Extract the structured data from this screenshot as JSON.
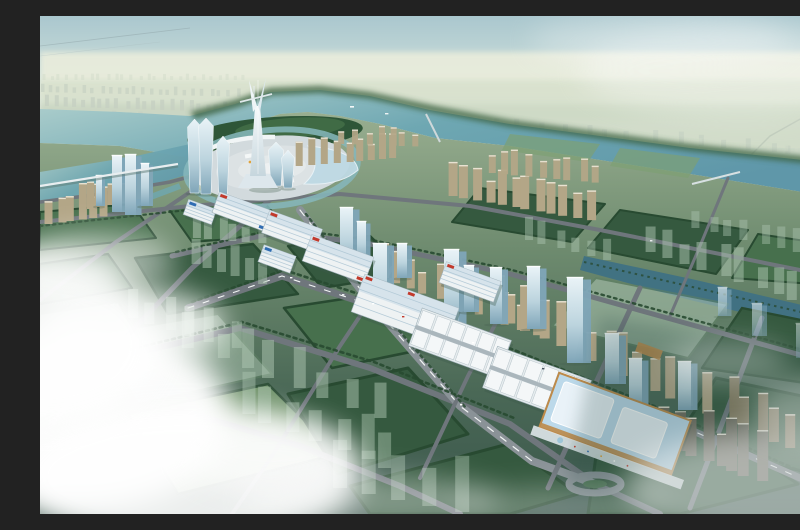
{
  "meta": {
    "description": "Aerial architectural rendering of a planned riverside city district with a landmark spire tower, circular central plaza, winding river, trade-center strip, exhibition hall and green development parcels under low clouds"
  },
  "palette": {
    "sky_top": "#aac7ce",
    "sky_mid": "#c9dcd9",
    "horizon": "#e7ece0",
    "sky_edge": "#eff1e6",
    "plain_hi": "#e8ecdc",
    "plain_md": "#d8e1cd",
    "plain_lo": "#cdd9c5",
    "plain_left": "#c9d5c3",
    "far_city": "#c5d0c2",
    "far_city_lt": "#d2dcca",
    "water_hi": "#b3d2cf",
    "water": "#6ea7b2",
    "water_lo": "#5f97a9",
    "water_dark": "#3f7184",
    "bank_green": "#3c6342",
    "forest": "#2e5638",
    "forest_lt": "#4c7a4f",
    "ground_hi": "#98ae90",
    "ground_md": "#6d8a6e",
    "ground_lo2": "#4a6856",
    "ground_lo": "#3a564b",
    "parcel_dark": "#35593f",
    "parcel_mid": "#47704d",
    "parcel_lt": "#7da073",
    "parcel_ghost": "#aec6b2",
    "hedge": "#284a31",
    "road": "#6f767c",
    "road_lt": "#8a9297",
    "dash": "#f2f5f4",
    "tan": "#b3a687",
    "tan_dk": "#8a7d62",
    "tan_cap": "#e8e2d2",
    "glass_hi": "#e9f3f7",
    "glass": "#bcd4de",
    "glass_dk": "#7fa5b8",
    "white_b": "#eef2f3",
    "roof_sh": "#aac3d2",
    "roof_blue": "#cfdfe9",
    "red": "#c23a2c",
    "blue": "#2f6cb3",
    "yellow": "#e0a33c",
    "expo_roof": "#bcd9ea",
    "expo_panel": "#e9f2f8",
    "expo_trim": "#bd8a4a",
    "spire_hi": "#f6fafb",
    "spire_lo": "#c6d6dd",
    "plaza": "#d2dadd",
    "plaza2": "#dce2e4",
    "plaza3": "#e4e9ea",
    "cloud": "#ffffff",
    "shadow": "#44604f"
  },
  "scene": {
    "clusters": [
      {
        "name": "far-city-row",
        "layer": "far",
        "x": 2,
        "y": 64,
        "n": 26,
        "dx": 8,
        "dy": 0,
        "w": 3,
        "h": 5,
        "fill": "far_city_lt",
        "op": 0.5
      },
      {
        "name": "far-city-row",
        "layer": "far",
        "x": 0,
        "y": 76,
        "n": 24,
        "dx": 8.5,
        "dy": 0.2,
        "w": 3.5,
        "h": 7,
        "fill": "far_city",
        "op": 0.65
      },
      {
        "name": "far-city-row",
        "layer": "far",
        "x": 4,
        "y": 90,
        "n": 22,
        "dx": 9,
        "dy": 0.3,
        "w": 4,
        "h": 9,
        "fill": "far_city",
        "op": 0.8
      },
      {
        "name": "far-city-row",
        "layer": "far",
        "x": 0,
        "y": 104,
        "n": 18,
        "dx": 10,
        "dy": 0.4,
        "w": 4.5,
        "h": 10,
        "fill": "far_city",
        "op": 0.85
      },
      {
        "name": "far-city-row",
        "layer": "far",
        "x": 30,
        "y": 118,
        "n": 12,
        "dx": 11,
        "dy": 0.5,
        "w": 5,
        "h": 11,
        "fill": "far_city",
        "op": 0.9
      },
      {
        "name": "north-bank-city",
        "layer": "far",
        "x": 336,
        "y": 102,
        "n": 20,
        "dx": 23,
        "dy": 2,
        "w": 5,
        "h": 10,
        "fill": "far_city",
        "op": 0.7
      },
      {
        "name": "north-bank-city",
        "layer": "far",
        "x": 390,
        "y": 124,
        "n": 18,
        "dx": 22,
        "dy": 2,
        "w": 6,
        "h": 13,
        "fill": "far_city",
        "op": 0.8
      },
      {
        "name": "north-bank-city",
        "layer": "far",
        "x": 470,
        "y": 148,
        "n": 16,
        "dx": 20,
        "dy": 2,
        "w": 7,
        "h": 14,
        "fill": "far_city",
        "op": 0.85
      },
      {
        "name": "north-bank-city",
        "layer": "far",
        "x": 560,
        "y": 172,
        "n": 13,
        "dx": 18,
        "dy": 2.2,
        "w": 7,
        "h": 15,
        "fill": "far_city",
        "op": 0.8
      },
      {
        "name": "north-bank-city",
        "layer": "far",
        "x": 650,
        "y": 198,
        "n": 10,
        "dx": 15,
        "dy": 2.4,
        "w": 8,
        "h": 16,
        "fill": "far_city",
        "op": 0.7
      },
      {
        "name": "far-tiny-city",
        "layer": "far",
        "x": 420,
        "y": 112,
        "n": 26,
        "dx": 14,
        "dy": 1,
        "w": 3.5,
        "h": 6,
        "fill": "far_city_lt",
        "op": 0.5
      },
      {
        "name": "riverside-residential",
        "layer": "mid",
        "x": 258,
        "y": 150,
        "n": 9,
        "dx": 11.5,
        "dy": -1,
        "w": 7,
        "h": 22,
        "fill": "tan",
        "op": 1,
        "cap": 1
      },
      {
        "name": "riverside-residential",
        "layer": "mid",
        "x": 300,
        "y": 128,
        "n": 7,
        "dx": 12,
        "dy": 0.4,
        "w": 6,
        "h": 16,
        "fill": "tan",
        "op": 0.92,
        "cap": 1
      },
      {
        "name": "southbank-residential",
        "layer": "mid",
        "x": 408,
        "y": 180,
        "n": 12,
        "dx": 12.5,
        "dy": 2.2,
        "w": 9,
        "h": 30,
        "fill": "tan",
        "op": 1,
        "cap": 1
      },
      {
        "name": "southbank-residential",
        "layer": "mid",
        "x": 448,
        "y": 157,
        "n": 9,
        "dx": 13,
        "dy": 1.2,
        "w": 7,
        "h": 21,
        "fill": "tan",
        "op": 0.95,
        "cap": 1
      },
      {
        "name": "west-residential",
        "layer": "mid",
        "x": 6,
        "y": 208,
        "n": 6,
        "dx": 11,
        "dy": -1.5,
        "w": 8,
        "h": 30,
        "fill": "tan",
        "op": 1,
        "cap": 1
      },
      {
        "name": "west-residential",
        "layer": "mid",
        "x": 46,
        "y": 193,
        "n": 7,
        "dx": 10,
        "dy": -2,
        "w": 7,
        "h": 26,
        "fill": "tan",
        "op": 1,
        "cap": 1
      },
      {
        "name": "strip-residential",
        "layer": "mid",
        "x": 338,
        "y": 262,
        "n": 12,
        "dx": 14,
        "dy": 5.2,
        "w": 8,
        "h": 30,
        "fill": "tan",
        "op": 1,
        "cap": 1
      },
      {
        "name": "strip-residential",
        "layer": "mid",
        "x": 452,
        "y": 300,
        "n": 14,
        "dx": 16,
        "dy": 7.5,
        "w": 10,
        "h": 40,
        "fill": "tan",
        "op": 1,
        "cap": 1
      },
      {
        "name": "strip-residential",
        "layer": "mid",
        "x": 686,
        "y": 408,
        "n": 7,
        "dx": 15,
        "dy": 6,
        "w": 10,
        "h": 38,
        "fill": "tan_dk",
        "op": 1,
        "cap": 1
      },
      {
        "name": "dark-residential",
        "layer": "mid",
        "x": 620,
        "y": 430,
        "n": 8,
        "dx": 13.5,
        "dy": 5,
        "w": 11,
        "h": 42,
        "fill": "#6f6a5e",
        "op": 1,
        "cap": 1
      },
      {
        "name": "ghost-towers",
        "layer": "mid",
        "x": 606,
        "y": 236,
        "n": 10,
        "dx": 18,
        "dy": 6,
        "w": 10,
        "h": 28,
        "fill": "parcel_ghost",
        "op": 0.5
      },
      {
        "name": "ghost-towers",
        "layer": "mid",
        "x": 655,
        "y": 212,
        "n": 8,
        "dx": 16,
        "dy": 4,
        "w": 8,
        "h": 20,
        "fill": "parcel_ghost",
        "op": 0.42
      },
      {
        "name": "ghost-towers",
        "layer": "mid",
        "x": 148,
        "y": 332,
        "n": 8,
        "dx": 26,
        "dy": 10,
        "w": 12,
        "h": 34,
        "fill": "parcel_ghost",
        "op": 0.5
      },
      {
        "name": "ghost-towers",
        "layer": "mid",
        "x": 198,
        "y": 398,
        "n": 7,
        "dx": 24,
        "dy": 9,
        "w": 13,
        "h": 40,
        "fill": "parcel_ghost",
        "op": 0.45
      },
      {
        "name": "ghost-towers",
        "layer": "mid",
        "x": 88,
        "y": 302,
        "n": 6,
        "dx": 20,
        "dy": 6,
        "w": 10,
        "h": 28,
        "fill": "parcel_ghost",
        "op": 0.48
      },
      {
        "name": "ghost-towers",
        "layer": "mid",
        "x": 484,
        "y": 224,
        "n": 6,
        "dx": 16,
        "dy": 4,
        "w": 8,
        "h": 20,
        "fill": "parcel_ghost",
        "op": 0.45
      },
      {
        "name": "ghost-towers",
        "layer": "mid",
        "x": 298,
        "y": 472,
        "n": 5,
        "dx": 30,
        "dy": 6,
        "w": 14,
        "h": 44,
        "fill": "parcel_ghost",
        "op": 0.42
      },
      {
        "name": "ghost-towers",
        "layer": "mid",
        "x": 150,
        "y": 248,
        "n": 6,
        "dx": 14,
        "dy": 4,
        "w": 9,
        "h": 24,
        "fill": "parcel_ghost",
        "op": 0.5
      },
      {
        "name": "ghost-towers",
        "layer": "mid",
        "x": 152,
        "y": 222,
        "n": 6,
        "dx": 13,
        "dy": 1,
        "w": 8,
        "h": 20,
        "fill": "parcel_ghost",
        "op": 0.55
      }
    ],
    "towers": [
      {
        "x": 150,
        "y": 177,
        "w": 9,
        "h": 74,
        "type": "flare"
      },
      {
        "x": 161,
        "y": 178,
        "w": 10,
        "h": 76,
        "type": "flare"
      },
      {
        "x": 179,
        "y": 182,
        "w": 8,
        "h": 62,
        "type": "flare"
      },
      {
        "x": 231,
        "y": 170,
        "w": 10,
        "h": 44,
        "type": "flare"
      },
      {
        "x": 244,
        "y": 172,
        "w": 8,
        "h": 38,
        "type": "flare"
      },
      {
        "x": 72,
        "y": 196,
        "w": 10,
        "h": 56,
        "type": "glass"
      },
      {
        "x": 85,
        "y": 199,
        "w": 11,
        "h": 60,
        "type": "glass"
      },
      {
        "x": 101,
        "y": 190,
        "w": 8,
        "h": 42,
        "type": "glass"
      },
      {
        "x": 56,
        "y": 190,
        "w": 6,
        "h": 30,
        "type": "glass"
      },
      {
        "x": 300,
        "y": 252,
        "w": 13,
        "h": 60,
        "type": "glass"
      },
      {
        "x": 317,
        "y": 246,
        "w": 9,
        "h": 40,
        "type": "glass"
      },
      {
        "x": 357,
        "y": 262,
        "w": 10,
        "h": 34,
        "type": "glass"
      },
      {
        "x": 333,
        "y": 300,
        "w": 14,
        "h": 72,
        "type": "glass"
      },
      {
        "x": 404,
        "y": 314,
        "w": 15,
        "h": 80,
        "type": "glass"
      },
      {
        "x": 424,
        "y": 296,
        "w": 10,
        "h": 46,
        "type": "glass"
      },
      {
        "x": 450,
        "y": 308,
        "w": 12,
        "h": 56,
        "type": "glass"
      },
      {
        "x": 487,
        "y": 313,
        "w": 13,
        "h": 62,
        "type": "glass"
      },
      {
        "x": 527,
        "y": 347,
        "w": 16,
        "h": 85,
        "type": "glass"
      },
      {
        "x": 565,
        "y": 368,
        "w": 14,
        "h": 50,
        "type": "glass"
      },
      {
        "x": 589,
        "y": 390,
        "w": 13,
        "h": 47,
        "type": "glass"
      },
      {
        "x": 638,
        "y": 394,
        "w": 13,
        "h": 48,
        "type": "glass"
      },
      {
        "x": 678,
        "y": 300,
        "w": 9,
        "h": 28,
        "type": "glass",
        "op": 0.65
      },
      {
        "x": 712,
        "y": 320,
        "w": 10,
        "h": 32,
        "type": "glass",
        "op": 0.55
      },
      {
        "x": 756,
        "y": 342,
        "w": 10,
        "h": 34,
        "type": "glass",
        "op": 0.45
      }
    ],
    "halls": [
      {
        "kind": "market",
        "cx": 160,
        "cy": 196,
        "w": 30,
        "h": 16,
        "rot": 20,
        "accents": [
          "blue"
        ]
      },
      {
        "kind": "market",
        "cx": 203,
        "cy": 196,
        "w": 58,
        "h": 22,
        "rot": 20,
        "accents": [
          "red",
          "blue"
        ]
      },
      {
        "kind": "market",
        "cx": 252,
        "cy": 215,
        "w": 56,
        "h": 24,
        "rot": 20,
        "accents": [
          "red"
        ]
      },
      {
        "kind": "market",
        "cx": 237,
        "cy": 243,
        "w": 34,
        "h": 18,
        "rot": 20,
        "accents": [
          "blue"
        ]
      },
      {
        "kind": "market",
        "cx": 298,
        "cy": 243,
        "w": 66,
        "h": 28,
        "rot": 20,
        "accents": [
          "red",
          "red"
        ]
      },
      {
        "kind": "market",
        "cx": 430,
        "cy": 266,
        "w": 58,
        "h": 22,
        "rot": 20,
        "accents": [
          "red"
        ]
      },
      {
        "kind": "market",
        "cx": 365,
        "cy": 294,
        "w": 100,
        "h": 40,
        "rot": 20,
        "accents": [
          "red",
          "blue",
          "red"
        ]
      },
      {
        "kind": "peaks",
        "cx": 420,
        "cy": 327,
        "w": 95,
        "h": 40,
        "rot": 20,
        "accents": []
      },
      {
        "kind": "peaks",
        "cx": 497,
        "cy": 368,
        "w": 100,
        "h": 44,
        "rot": 20,
        "accents": []
      },
      {
        "kind": "expo",
        "cx": 575,
        "cy": 408,
        "w": 140,
        "h": 58,
        "rot": 20,
        "accents": []
      }
    ]
  }
}
